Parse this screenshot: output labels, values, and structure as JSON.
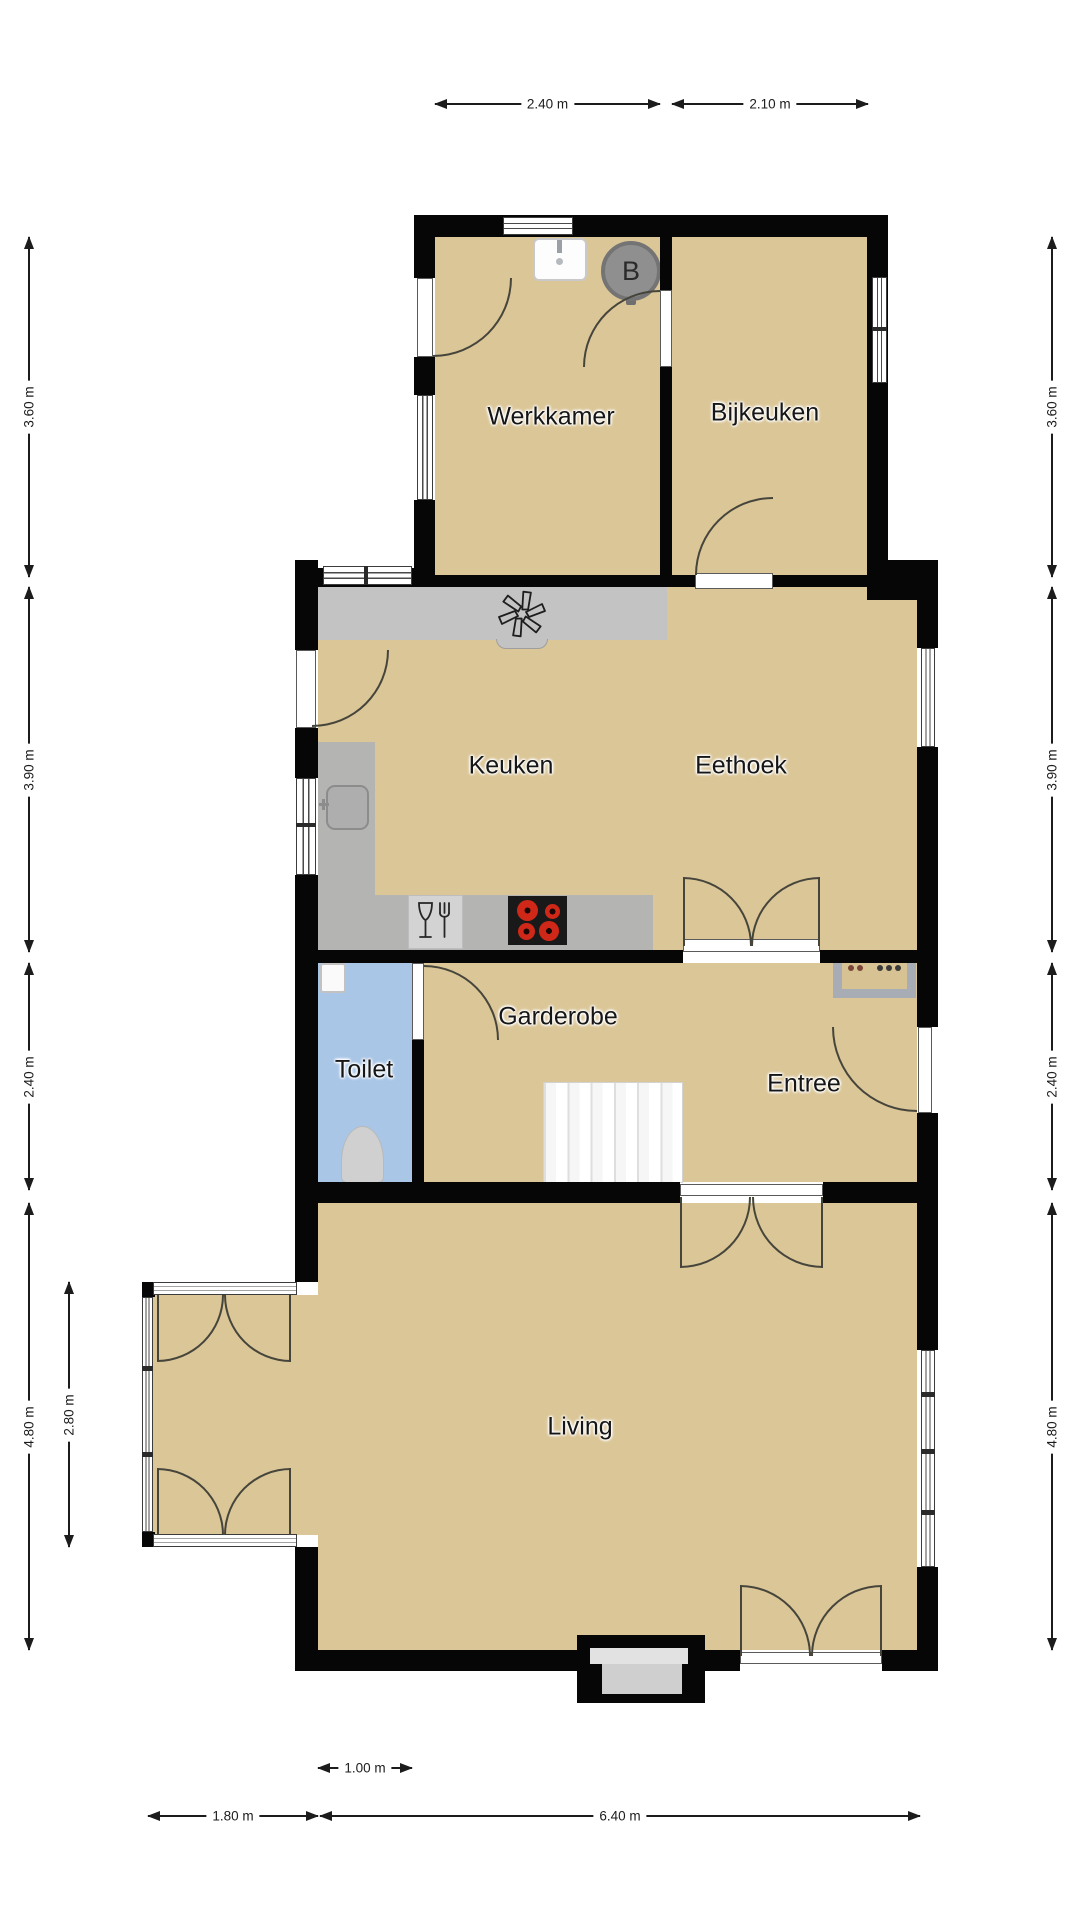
{
  "plan": {
    "title": "Floor plan (begane grond)",
    "rooms": [
      {
        "id": "werkkamer",
        "label": "Werkkamer"
      },
      {
        "id": "bijkeuken",
        "label": "Bijkeuken"
      },
      {
        "id": "keuken",
        "label": "Keuken"
      },
      {
        "id": "eethoek",
        "label": "Eethoek"
      },
      {
        "id": "garderobe",
        "label": "Garderobe"
      },
      {
        "id": "toilet",
        "label": "Toilet"
      },
      {
        "id": "entree",
        "label": "Entree"
      },
      {
        "id": "living",
        "label": "Living"
      }
    ],
    "boiler_label": "B",
    "dimensions": {
      "top": [
        "2.40 m",
        "2.10 m"
      ],
      "left": [
        "3.60 m",
        "3.90 m",
        "2.40 m",
        "4.80 m"
      ],
      "left_inner": "2.80 m",
      "right": [
        "3.60 m",
        "3.90 m",
        "2.40 m",
        "4.80 m"
      ],
      "bottom": [
        "1.80 m",
        "6.40 m"
      ],
      "bottom_inner": "1.00 m"
    },
    "icons": [
      "extractor-fan-icon",
      "glass-fork-icon",
      "stove-icon",
      "sink-icon",
      "toilet-icon",
      "boiler-icon",
      "stairs",
      "doormat"
    ],
    "colors": {
      "floor": "#dbc697",
      "toilet_floor": "#a9c6e7",
      "wall": "#060606",
      "counter": "#c3c3c3",
      "counter_dark": "#b4b4b3",
      "stairs": "#f3f3f3",
      "boiler": "#8f8f8f",
      "burner": "#d02818",
      "doormat_border": "#a8adb5"
    }
  }
}
